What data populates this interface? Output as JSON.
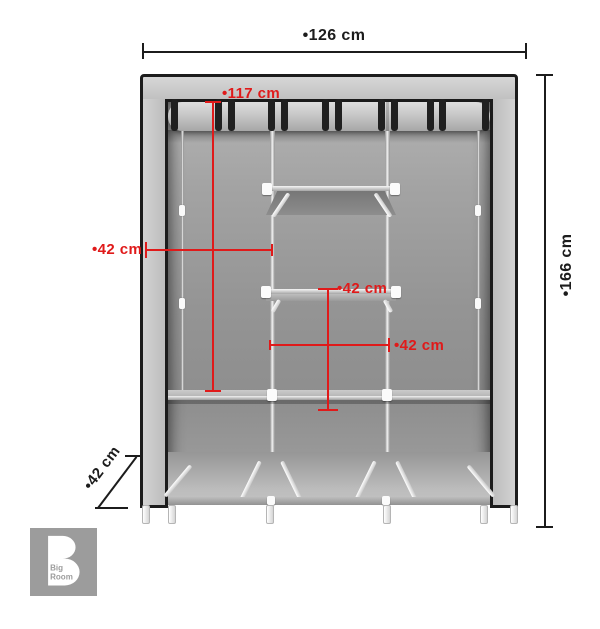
{
  "diagram": {
    "dimensions": {
      "width": {
        "label": "•126 cm"
      },
      "height": {
        "label": "•166 cm"
      },
      "rail_height": {
        "label": "•117 cm"
      },
      "left_section_width": {
        "label": "•42 cm"
      },
      "middle_section_height": {
        "label": "•42 cm"
      },
      "middle_section_width": {
        "label": "•42 cm"
      },
      "depth": {
        "label": "•42 cm"
      }
    }
  },
  "logo": {
    "mark": "B",
    "line1": "Big",
    "line2": "Room"
  },
  "colors": {
    "dimension_red": "#e01a1a",
    "outline_ink": "#1c1c1c",
    "logo_gray": "#9c9c9c",
    "fabric_gray": "#c6c6c6"
  }
}
